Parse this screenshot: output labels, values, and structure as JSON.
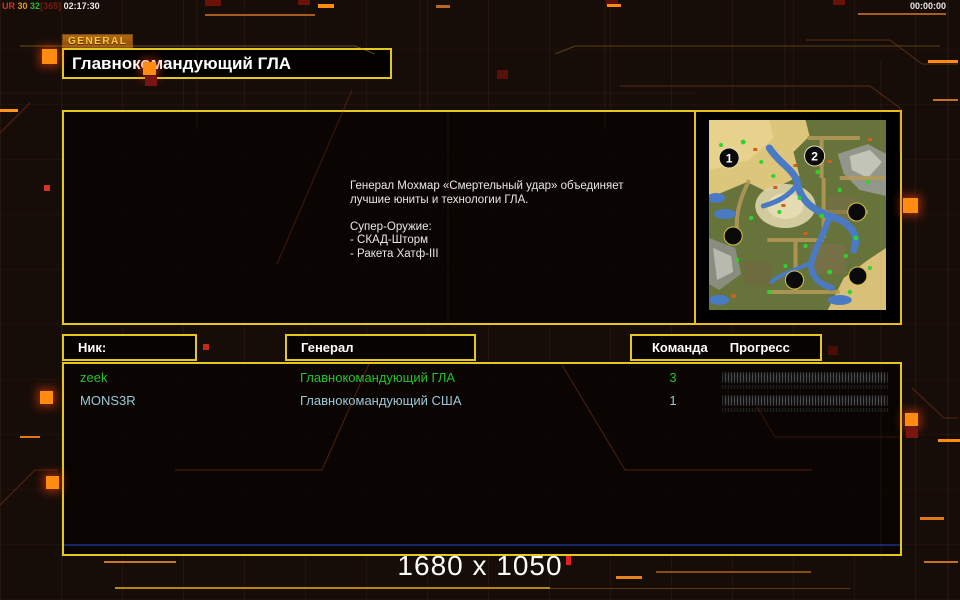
{
  "hud": {
    "net_ur": "UR",
    "net_v1": "30",
    "net_v2": "32",
    "net_bracket": "[365]",
    "net_time": "02:17:30",
    "timer": "00:00:00",
    "resolution": "1680 x 1050"
  },
  "general_tab": "GENERAL",
  "title": "Главнокомандующий ГЛА",
  "briefing": {
    "text": "Генерал Мохмар «Смертельный удар» объединяет\n лучшие юниты и технологии ГЛА.\n\nСупер-Оружие:\n- СКАД-Шторм\n- Ракета Хатф-III"
  },
  "map_preview": {
    "start_positions": [
      "1",
      "2"
    ]
  },
  "lobby": {
    "headers": {
      "nick": "Ник:",
      "general": "Генерал",
      "team": "Команда",
      "progress": "Прогресс"
    },
    "players": [
      {
        "nick": "zeek",
        "general": "Главнокомандующий ГЛА",
        "team": "3",
        "color": "#22c428",
        "progress_percent": 0
      },
      {
        "nick": "MONS3R",
        "general": "Главнокомандующий США",
        "team": "1",
        "color": "#9cc8d8",
        "progress_percent": 0
      }
    ]
  },
  "colors": {
    "accent_yellow": "#e4c71f",
    "accent_orange": "#ff8c10",
    "player_green": "#22c428",
    "player_blue": "#9cc8d8",
    "background": "#170d08"
  }
}
